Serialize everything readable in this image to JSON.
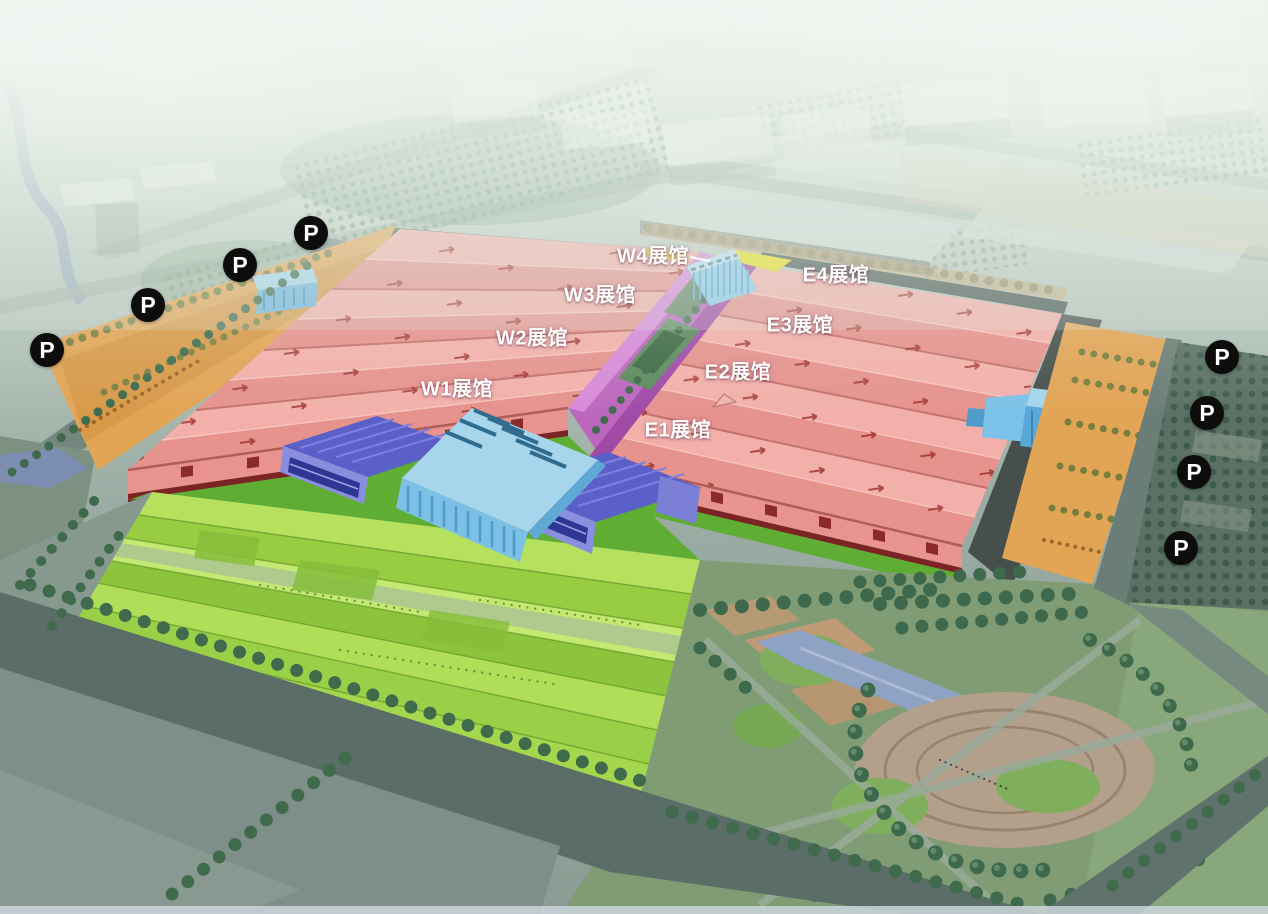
{
  "map": {
    "halls": [
      {
        "id": "W1",
        "label": "W1展馆",
        "pos_style": "left:457px;top:387px"
      },
      {
        "id": "W2",
        "label": "W2展馆",
        "pos_style": "left:532px;top:336px"
      },
      {
        "id": "W3",
        "label": "W3展馆",
        "pos_style": "left:600px;top:293px"
      },
      {
        "id": "W4",
        "label": "W4展馆",
        "pos_style": "left:653px;top:254px"
      },
      {
        "id": "E1",
        "label": "E1展馆",
        "pos_style": "left:678px;top:428px"
      },
      {
        "id": "E2",
        "label": "E2展馆",
        "pos_style": "left:738px;top:370px"
      },
      {
        "id": "E3",
        "label": "E3展馆",
        "pos_style": "left:800px;top:323px"
      },
      {
        "id": "E4",
        "label": "E4展馆",
        "pos_style": "left:836px;top:273px"
      }
    ],
    "parking_symbol": "P",
    "parking_markers": [
      {
        "pos_style": "left:311px;top:233px"
      },
      {
        "pos_style": "left:240px;top:265px"
      },
      {
        "pos_style": "left:148px;top:305px"
      },
      {
        "pos_style": "left:47px;top:350px"
      },
      {
        "pos_style": "left:1222px;top:357px"
      },
      {
        "pos_style": "left:1207px;top:413px"
      },
      {
        "pos_style": "left:1194px;top:472px"
      },
      {
        "pos_style": "left:1181px;top:548px"
      }
    ],
    "colors": {
      "hall_roof_pink": "#ee9e99",
      "corridor_magenta": "#bc66be",
      "entrance_glass_blue": "#8ccae8",
      "side_hall_purple": "#5b5fc8",
      "parking_lot_orange": "#e2a455",
      "lawn_green": "#a6d84e",
      "park_green": "#7f9c74",
      "accent_yellow": "#e6dd1a",
      "marker_background": "#0d0d0d",
      "marker_text": "#ffffff",
      "label_text": "#ffffff"
    }
  }
}
